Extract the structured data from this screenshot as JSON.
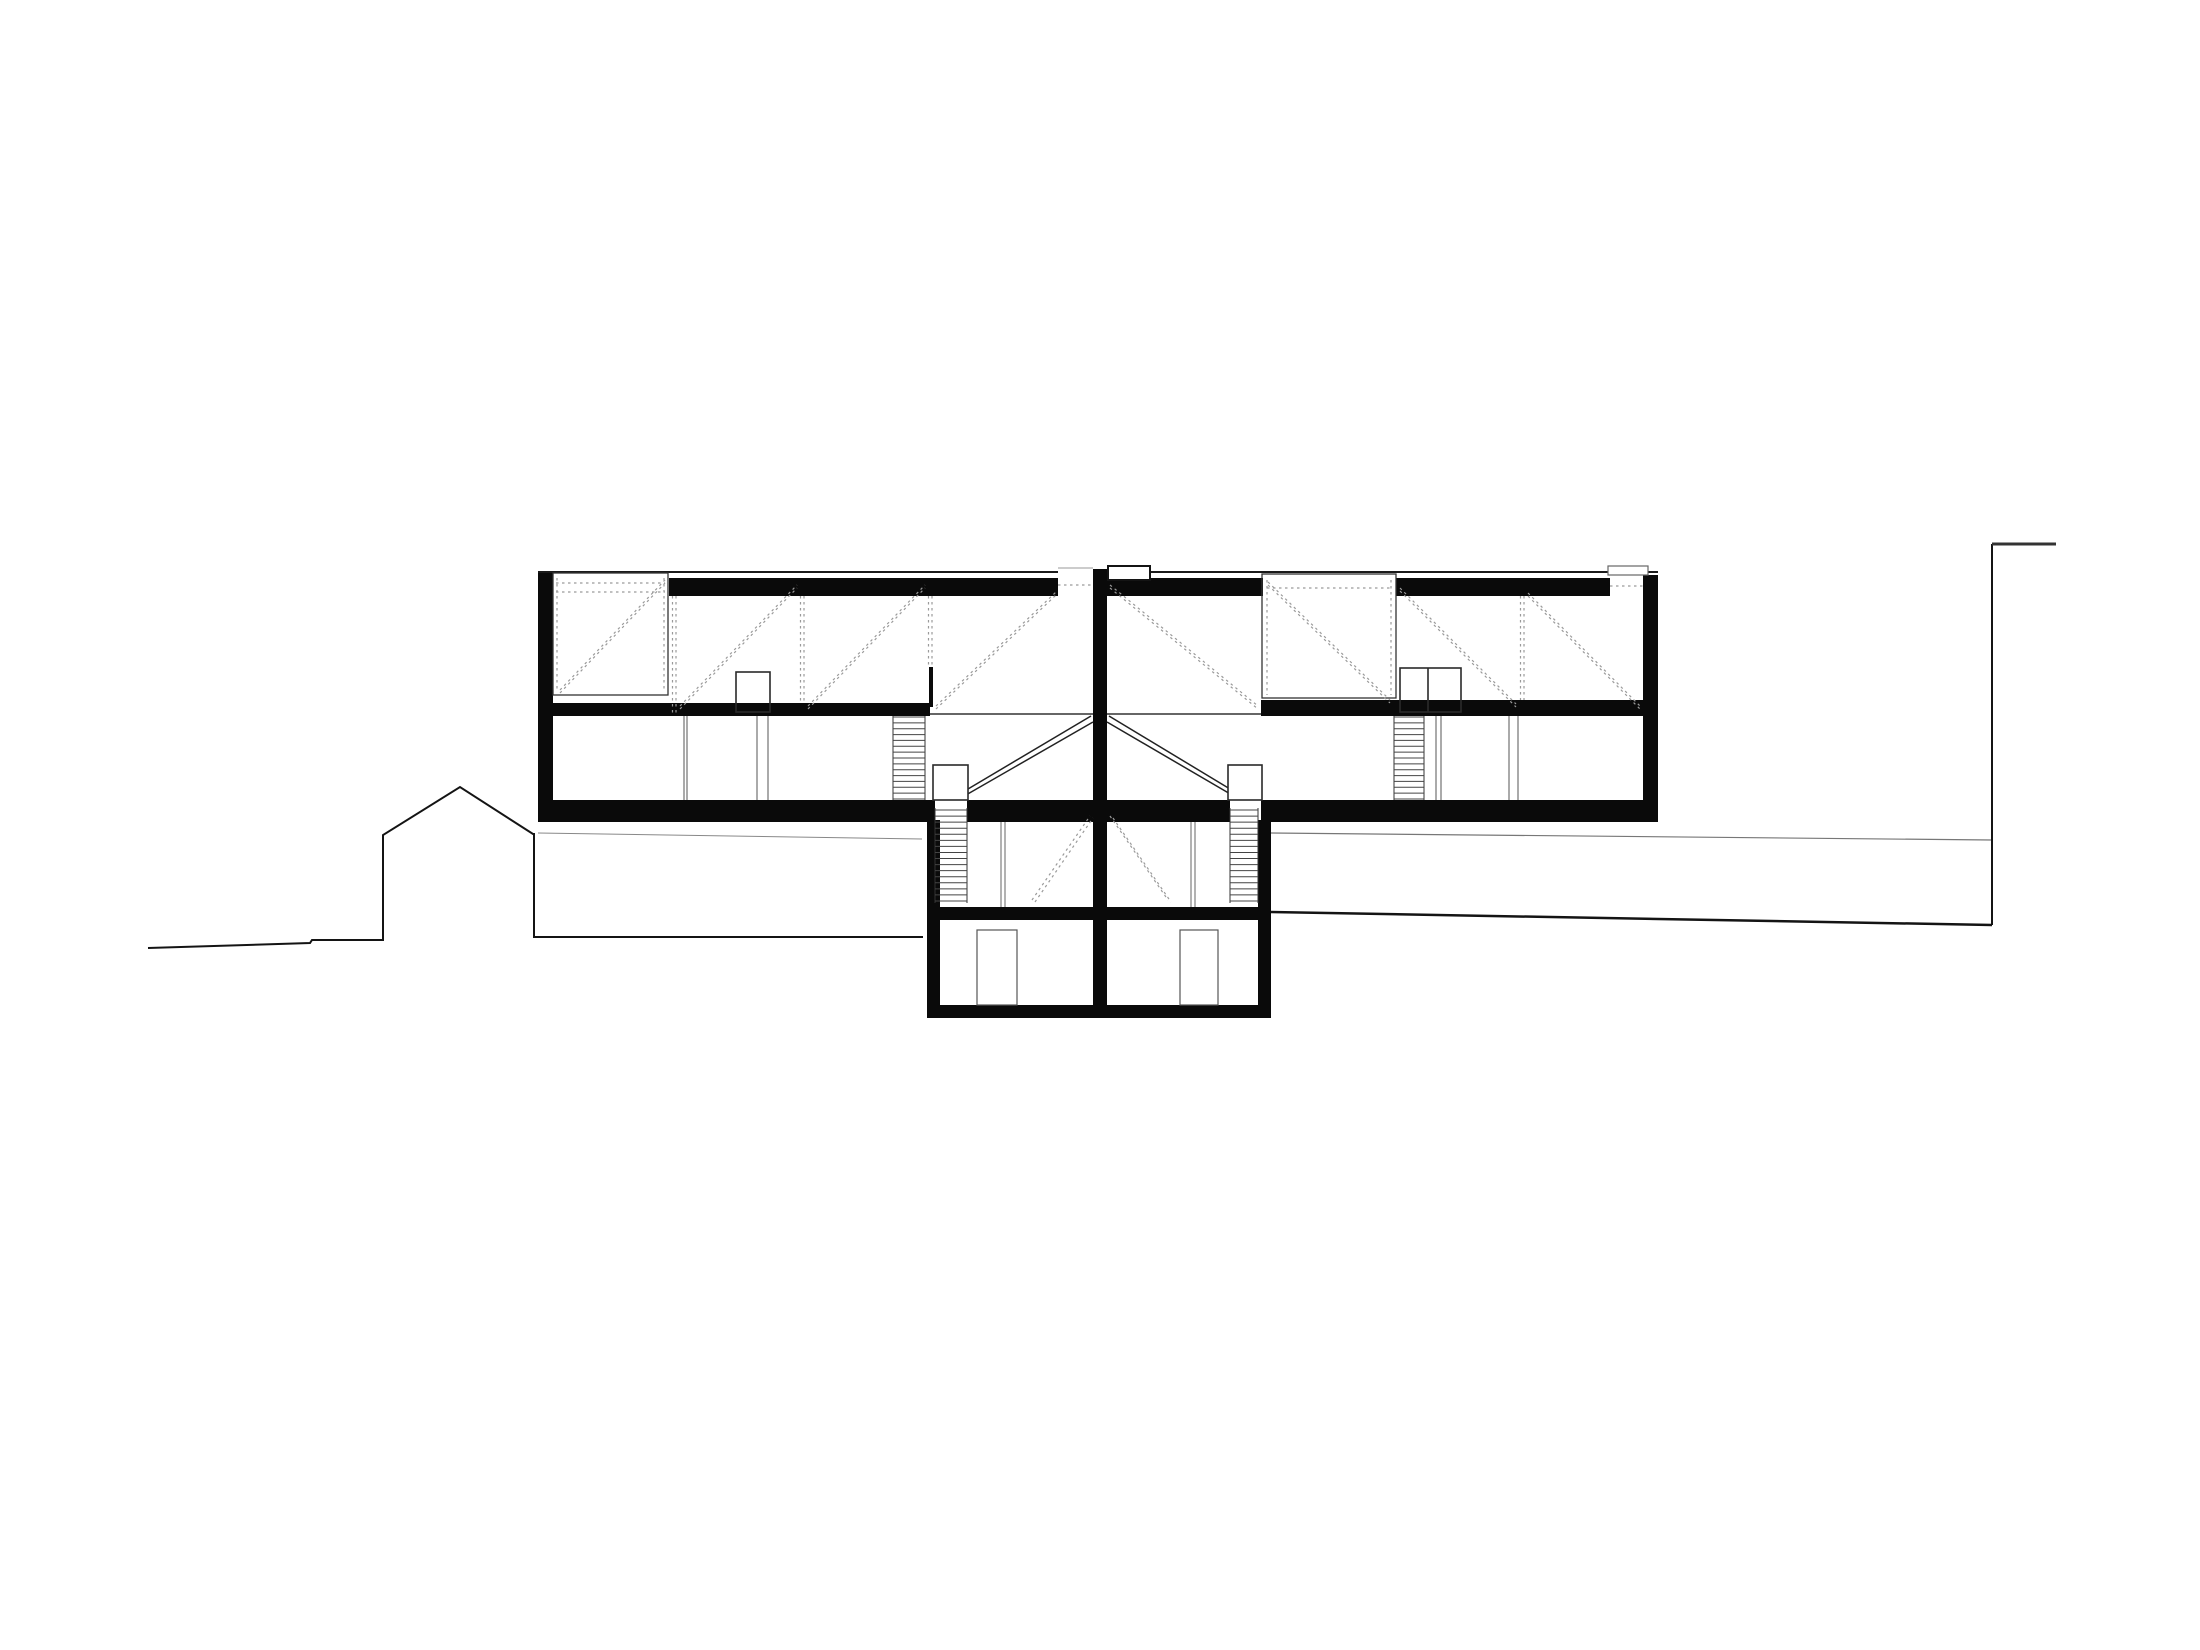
{
  "meta": {
    "title": "Architectural cross-section drawing of a two-unit house on a slope",
    "drawing_type": "building-section",
    "canvas": {
      "w": 2200,
      "h": 1650
    },
    "colors": {
      "background": "#ffffff",
      "ink": "#0a0a0a",
      "truss_dash": "#9a9a9a",
      "thin_line": "#555555"
    }
  },
  "drawing": {
    "terrain": [
      {
        "t": "p",
        "pts": [
          [
            148,
            948
          ],
          [
            310,
            943
          ],
          [
            312,
            940
          ],
          [
            383,
            940
          ],
          [
            383,
            835
          ],
          [
            460,
            787
          ],
          [
            533,
            834
          ],
          [
            534,
            834
          ],
          [
            534,
            937
          ],
          [
            923,
            937
          ]
        ],
        "w": 2,
        "c": "#141414"
      },
      {
        "t": "l",
        "x1": 538,
        "y1": 833,
        "x2": 922,
        "y2": 839,
        "w": 1,
        "c": "#888888"
      },
      {
        "t": "l",
        "x1": 1271,
        "y1": 833,
        "x2": 1992,
        "y2": 840,
        "w": 1.2,
        "c": "#777777"
      },
      {
        "t": "l",
        "x1": 1271,
        "y1": 912,
        "x2": 1992,
        "y2": 925,
        "w": 2.5,
        "c": "#141414"
      },
      {
        "t": "l",
        "x1": 1992,
        "y1": 544,
        "x2": 1992,
        "y2": 925,
        "w": 2,
        "c": "#141414"
      },
      {
        "t": "l",
        "x1": 1992,
        "y1": 544,
        "x2": 2056,
        "y2": 544,
        "w": 3,
        "c": "#333333"
      }
    ],
    "shell": [
      {
        "t": "r",
        "x": 538,
        "y": 573,
        "w": 15,
        "h": 247
      },
      {
        "t": "r",
        "x": 1643,
        "y": 575,
        "w": 15,
        "h": 245
      },
      {
        "t": "r",
        "x": 1093,
        "y": 569,
        "w": 14,
        "h": 436
      },
      {
        "t": "r",
        "x": 669,
        "y": 578,
        "w": 389,
        "h": 18
      },
      {
        "t": "r",
        "x": 1107,
        "y": 578,
        "w": 156,
        "h": 18
      },
      {
        "t": "r",
        "x": 1396,
        "y": 578,
        "w": 214,
        "h": 18
      },
      {
        "t": "r",
        "x": 552,
        "y": 703,
        "w": 378,
        "h": 13
      },
      {
        "t": "r",
        "x": 1261,
        "y": 700,
        "w": 382,
        "h": 16
      },
      {
        "t": "r",
        "x": 538,
        "y": 800,
        "w": 397,
        "h": 22
      },
      {
        "t": "r",
        "x": 967,
        "y": 800,
        "w": 263,
        "h": 22
      },
      {
        "t": "r",
        "x": 1261,
        "y": 800,
        "w": 397,
        "h": 22
      },
      {
        "t": "r",
        "x": 927,
        "y": 820,
        "w": 13,
        "h": 198
      },
      {
        "t": "r",
        "x": 1258,
        "y": 820,
        "w": 13,
        "h": 198
      },
      {
        "t": "r",
        "x": 927,
        "y": 907,
        "w": 344,
        "h": 13
      },
      {
        "t": "r",
        "x": 927,
        "y": 1005,
        "w": 344,
        "h": 13
      },
      {
        "t": "r",
        "x": 929,
        "y": 667,
        "w": 4,
        "h": 40
      }
    ],
    "outlines": [
      {
        "t": "l",
        "x1": 538,
        "y1": 572,
        "x2": 1058,
        "y2": 572,
        "w": 2,
        "c": "#1a1a1a"
      },
      {
        "t": "l",
        "x1": 1058,
        "y1": 568,
        "x2": 1093,
        "y2": 568,
        "w": 1,
        "c": "#999999"
      },
      {
        "t": "l",
        "x1": 1107,
        "y1": 572,
        "x2": 1608,
        "y2": 572,
        "w": 2,
        "c": "#1a1a1a"
      },
      {
        "t": "l",
        "x1": 1643,
        "y1": 572,
        "x2": 1658,
        "y2": 572,
        "w": 2,
        "c": "#1a1a1a"
      },
      {
        "t": "r",
        "x": 1108,
        "y": 566,
        "w": 42,
        "h": 14,
        "f": "#ffffff",
        "s": "#141414",
        "sw": 2
      },
      {
        "t": "r",
        "x": 1608,
        "y": 566,
        "w": 40,
        "h": 9,
        "f": "#ffffff",
        "s": "#666666",
        "sw": 1.2
      },
      {
        "t": "r",
        "x": 553,
        "y": 573,
        "w": 115,
        "h": 122,
        "f": "none",
        "s": "#333333",
        "sw": 1.3
      },
      {
        "t": "r",
        "x": 1262,
        "y": 574,
        "w": 134,
        "h": 124,
        "f": "none",
        "s": "#333333",
        "sw": 1.3
      },
      {
        "t": "l",
        "x1": 930,
        "y1": 714,
        "x2": 1093,
        "y2": 714,
        "w": 1.5,
        "c": "#333333"
      },
      {
        "t": "l",
        "x1": 1107,
        "y1": 714,
        "x2": 1261,
        "y2": 714,
        "w": 1.5,
        "c": "#333333"
      }
    ],
    "openings": [
      {
        "t": "r",
        "x": 736,
        "y": 672,
        "w": 34,
        "h": 40,
        "f": "none",
        "s": "#2a2a2a",
        "sw": 1.6
      },
      {
        "t": "r",
        "x": 1400,
        "y": 668,
        "w": 61,
        "h": 44,
        "f": "none",
        "s": "#2a2a2a",
        "sw": 1.6
      },
      {
        "t": "l",
        "x1": 1428,
        "y1": 668,
        "x2": 1428,
        "y2": 712,
        "w": 1.6,
        "c": "#2a2a2a"
      },
      {
        "t": "l",
        "x1": 684,
        "y1": 716,
        "x2": 684,
        "y2": 800,
        "w": 1,
        "c": "#555555"
      },
      {
        "t": "l",
        "x1": 687,
        "y1": 716,
        "x2": 687,
        "y2": 800,
        "w": 1,
        "c": "#555555"
      },
      {
        "t": "l",
        "x1": 757,
        "y1": 716,
        "x2": 757,
        "y2": 800,
        "w": 1,
        "c": "#555555"
      },
      {
        "t": "l",
        "x1": 768,
        "y1": 716,
        "x2": 768,
        "y2": 800,
        "w": 1,
        "c": "#555555"
      },
      {
        "t": "l",
        "x1": 1436,
        "y1": 716,
        "x2": 1436,
        "y2": 800,
        "w": 1,
        "c": "#555555"
      },
      {
        "t": "l",
        "x1": 1441,
        "y1": 716,
        "x2": 1441,
        "y2": 800,
        "w": 1,
        "c": "#555555"
      },
      {
        "t": "l",
        "x1": 1509,
        "y1": 716,
        "x2": 1509,
        "y2": 800,
        "w": 1,
        "c": "#555555"
      },
      {
        "t": "l",
        "x1": 1518,
        "y1": 716,
        "x2": 1518,
        "y2": 800,
        "w": 1,
        "c": "#555555"
      },
      {
        "t": "r",
        "x": 933,
        "y": 765,
        "w": 35,
        "h": 35,
        "f": "#ffffff",
        "s": "#2a2a2a",
        "sw": 1.6
      },
      {
        "t": "r",
        "x": 1228,
        "y": 765,
        "w": 34,
        "h": 35,
        "f": "#ffffff",
        "s": "#2a2a2a",
        "sw": 1.6
      },
      {
        "t": "l",
        "x1": 1001,
        "y1": 822,
        "x2": 1001,
        "y2": 907,
        "w": 1,
        "c": "#666666"
      },
      {
        "t": "l",
        "x1": 1005,
        "y1": 822,
        "x2": 1005,
        "y2": 907,
        "w": 1,
        "c": "#666666"
      },
      {
        "t": "l",
        "x1": 1191,
        "y1": 822,
        "x2": 1191,
        "y2": 907,
        "w": 1,
        "c": "#666666"
      },
      {
        "t": "l",
        "x1": 1195,
        "y1": 822,
        "x2": 1195,
        "y2": 907,
        "w": 1,
        "c": "#666666"
      },
      {
        "t": "r",
        "x": 977,
        "y": 930,
        "w": 40,
        "h": 75,
        "f": "none",
        "s": "#555555",
        "sw": 1.2
      },
      {
        "t": "r",
        "x": 1180,
        "y": 930,
        "w": 38,
        "h": 75,
        "f": "none",
        "s": "#555555",
        "sw": 1.2
      }
    ],
    "stairs": [
      {
        "t": "l",
        "x1": 893,
        "y1": 716,
        "x2": 893,
        "y2": 800,
        "w": 1,
        "c": "#333333"
      },
      {
        "t": "l",
        "x1": 925,
        "y1": 716,
        "x2": 925,
        "y2": 800,
        "w": 1,
        "c": "#333333"
      },
      {
        "t": "l",
        "x1": 1394,
        "y1": 716,
        "x2": 1394,
        "y2": 800,
        "w": 1,
        "c": "#333333"
      },
      {
        "t": "l",
        "x1": 1424,
        "y1": 716,
        "x2": 1424,
        "y2": 800,
        "w": 1,
        "c": "#333333"
      },
      {
        "t": "l",
        "x1": 935,
        "y1": 808,
        "x2": 935,
        "y2": 903,
        "w": 1,
        "c": "#333333"
      },
      {
        "t": "l",
        "x1": 967,
        "y1": 808,
        "x2": 967,
        "y2": 903,
        "w": 1,
        "c": "#333333"
      },
      {
        "t": "l",
        "x1": 1230,
        "y1": 808,
        "x2": 1230,
        "y2": 903,
        "w": 1,
        "c": "#333333"
      },
      {
        "t": "l",
        "x1": 1258,
        "y1": 808,
        "x2": 1258,
        "y2": 903,
        "w": 1,
        "c": "#333333"
      },
      {
        "t": "tr",
        "x1": 893,
        "x2": 925,
        "y1": 717,
        "y2": 799,
        "n": 15,
        "w": 1,
        "c": "#444444"
      },
      {
        "t": "tr",
        "x1": 1394,
        "x2": 1424,
        "y1": 717,
        "y2": 799,
        "n": 15,
        "w": 1,
        "c": "#444444"
      },
      {
        "t": "tr",
        "x1": 935,
        "x2": 967,
        "y1": 810,
        "y2": 901,
        "n": 16,
        "w": 1,
        "c": "#444444"
      },
      {
        "t": "tr",
        "x1": 1230,
        "x2": 1258,
        "y1": 810,
        "y2": 901,
        "n": 16,
        "w": 1,
        "c": "#444444"
      },
      {
        "t": "l",
        "x1": 968,
        "y1": 789,
        "x2": 1091,
        "y2": 716,
        "w": 1.5,
        "c": "#222222"
      },
      {
        "t": "l",
        "x1": 966,
        "y1": 795,
        "x2": 1093,
        "y2": 722,
        "w": 1.5,
        "c": "#222222"
      },
      {
        "t": "l",
        "x1": 1109,
        "y1": 716,
        "x2": 1230,
        "y2": 789,
        "w": 1.5,
        "c": "#222222"
      },
      {
        "t": "l",
        "x1": 1107,
        "y1": 722,
        "x2": 1232,
        "y2": 795,
        "w": 1.5,
        "c": "#222222"
      }
    ],
    "truss": [
      {
        "t": "l",
        "x1": 672.5,
        "y1": 596,
        "x2": 672.5,
        "y2": 713
      },
      {
        "t": "l",
        "x1": 676,
        "y1": 596,
        "x2": 676,
        "y2": 713
      },
      {
        "t": "l",
        "x1": 800.5,
        "y1": 596,
        "x2": 800.5,
        "y2": 703
      },
      {
        "t": "l",
        "x1": 804,
        "y1": 596,
        "x2": 804,
        "y2": 703
      },
      {
        "t": "l",
        "x1": 928.5,
        "y1": 596,
        "x2": 928.5,
        "y2": 667
      },
      {
        "t": "l",
        "x1": 932,
        "y1": 596,
        "x2": 932,
        "y2": 667
      },
      {
        "t": "l",
        "x1": 1520.5,
        "y1": 596,
        "x2": 1520.5,
        "y2": 700
      },
      {
        "t": "l",
        "x1": 1524,
        "y1": 596,
        "x2": 1524,
        "y2": 700
      },
      {
        "t": "l",
        "x1": 557,
        "y1": 578,
        "x2": 557,
        "y2": 692
      },
      {
        "t": "l",
        "x1": 664,
        "y1": 578,
        "x2": 664,
        "y2": 692
      },
      {
        "t": "l",
        "x1": 1267,
        "y1": 580,
        "x2": 1267,
        "y2": 695
      },
      {
        "t": "l",
        "x1": 1391,
        "y1": 580,
        "x2": 1391,
        "y2": 695
      },
      {
        "t": "l",
        "x1": 556,
        "y1": 583,
        "x2": 665,
        "y2": 583
      },
      {
        "t": "l",
        "x1": 556,
        "y1": 592,
        "x2": 665,
        "y2": 592
      },
      {
        "t": "l",
        "x1": 1267,
        "y1": 588,
        "x2": 1391,
        "y2": 588
      },
      {
        "t": "l",
        "x1": 1058,
        "y1": 585,
        "x2": 1093,
        "y2": 585
      },
      {
        "t": "l",
        "x1": 1610,
        "y1": 586,
        "x2": 1643,
        "y2": 586
      },
      {
        "t": "l",
        "x1": 560,
        "y1": 690,
        "x2": 665,
        "y2": 580
      },
      {
        "t": "l",
        "x1": 560,
        "y1": 693,
        "x2": 665,
        "y2": 583
      },
      {
        "t": "l",
        "x1": 680,
        "y1": 706,
        "x2": 797,
        "y2": 585
      },
      {
        "t": "l",
        "x1": 680,
        "y1": 709,
        "x2": 797,
        "y2": 588
      },
      {
        "t": "l",
        "x1": 808,
        "y1": 706,
        "x2": 925,
        "y2": 585
      },
      {
        "t": "l",
        "x1": 808,
        "y1": 709,
        "x2": 925,
        "y2": 588
      },
      {
        "t": "l",
        "x1": 936,
        "y1": 706,
        "x2": 1056,
        "y2": 592
      },
      {
        "t": "l",
        "x1": 936,
        "y1": 709,
        "x2": 1056,
        "y2": 595
      },
      {
        "t": "l",
        "x1": 1110,
        "y1": 585,
        "x2": 1258,
        "y2": 706
      },
      {
        "t": "l",
        "x1": 1110,
        "y1": 588,
        "x2": 1258,
        "y2": 709
      },
      {
        "t": "l",
        "x1": 1268,
        "y1": 582,
        "x2": 1390,
        "y2": 700
      },
      {
        "t": "l",
        "x1": 1268,
        "y1": 585,
        "x2": 1390,
        "y2": 703
      },
      {
        "t": "l",
        "x1": 1400,
        "y1": 588,
        "x2": 1516,
        "y2": 704
      },
      {
        "t": "l",
        "x1": 1400,
        "y1": 591,
        "x2": 1516,
        "y2": 707
      },
      {
        "t": "l",
        "x1": 1528,
        "y1": 593,
        "x2": 1640,
        "y2": 706
      },
      {
        "t": "l",
        "x1": 1528,
        "y1": 596,
        "x2": 1640,
        "y2": 709
      },
      {
        "t": "l",
        "x1": 1032,
        "y1": 900,
        "x2": 1090,
        "y2": 816
      },
      {
        "t": "l",
        "x1": 1035,
        "y1": 902,
        "x2": 1093,
        "y2": 818
      },
      {
        "t": "l",
        "x1": 1110,
        "y1": 816,
        "x2": 1168,
        "y2": 900
      },
      {
        "t": "l",
        "x1": 1113,
        "y1": 818,
        "x2": 1171,
        "y2": 902
      }
    ]
  }
}
